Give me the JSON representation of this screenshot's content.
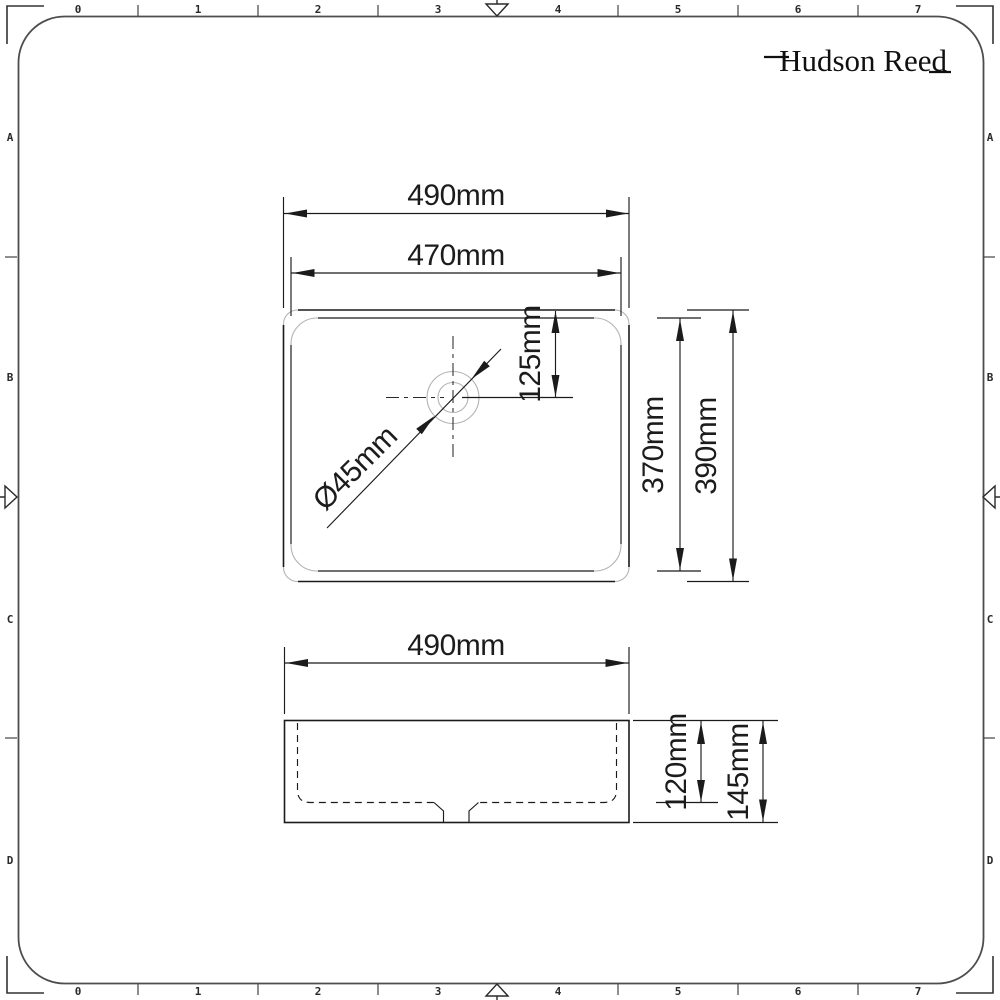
{
  "brand": {
    "name": "Hudson Reed"
  },
  "frame": {
    "columns": [
      "0",
      "1",
      "2",
      "3",
      "4",
      "5",
      "6",
      "7"
    ],
    "rows": [
      "A",
      "B",
      "C",
      "D"
    ]
  },
  "plan_view": {
    "outer_width": "490mm",
    "inner_width": "470mm",
    "drain_offset_from_back": "125mm",
    "drain_diameter": "Ø45mm",
    "inner_depth": "370mm",
    "outer_depth": "390mm"
  },
  "front_view": {
    "outer_width": "490mm",
    "inner_height": "120mm",
    "outer_height": "145mm"
  },
  "colors": {
    "line": "#1b1b1b",
    "frame": "#4d4d4d",
    "light_line": "#b3b3b3",
    "background": "#ffffff"
  }
}
